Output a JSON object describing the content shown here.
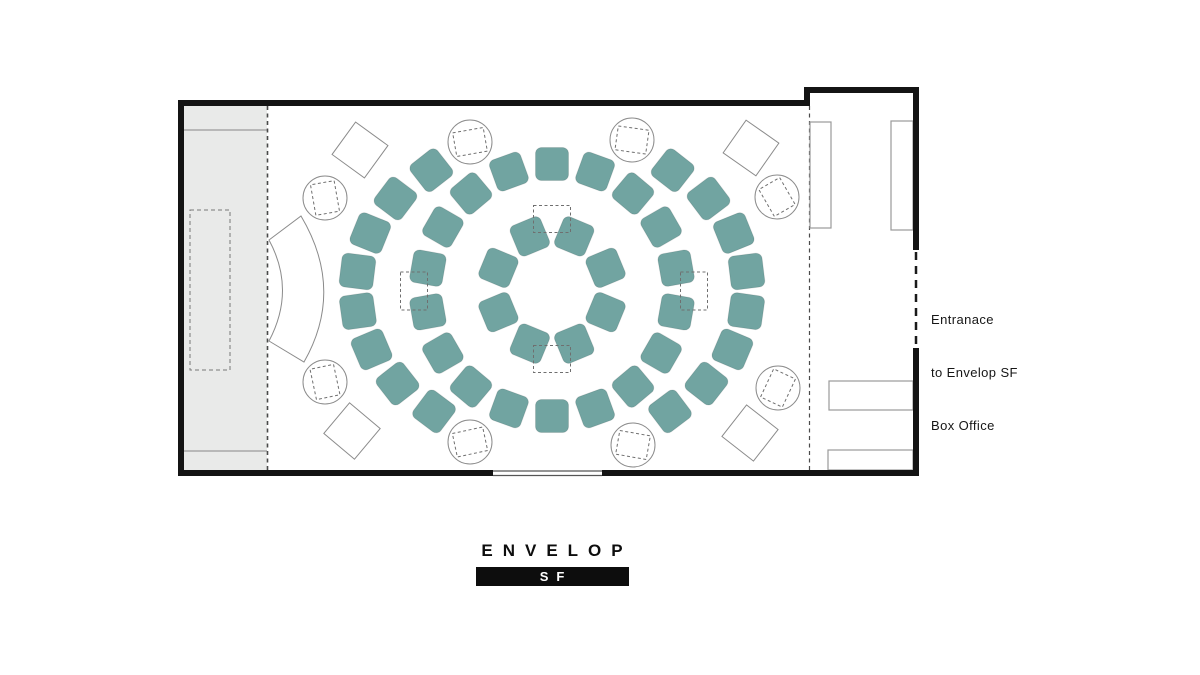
{
  "labels": {
    "entrance_line1": "Entranace",
    "entrance_line2": "to Envelop SF",
    "box_office": "Box Office",
    "logo": "ENVELOP",
    "logo_sub": "SF"
  },
  "colors": {
    "seat": "#71a4a1",
    "seat_edge": "rgba(0,0,0,0.10)",
    "wall": "#141414",
    "stage_fill": "#e9eae9",
    "outline": "#8b8b8b",
    "dashed": "#6f6f6f"
  },
  "seating": {
    "center": {
      "x": 552,
      "y": 290
    },
    "rings": [
      {
        "name": "inner-ring",
        "rx": 58,
        "ry": 58,
        "size": 33,
        "angles": [
          22.5,
          67.5,
          112.5,
          157.5,
          202.5,
          247.5,
          292.5,
          337.5
        ]
      },
      {
        "name": "middle-ring",
        "rx": 126,
        "ry": 126,
        "size": 33,
        "angles": [
          0,
          20,
          40,
          60,
          80,
          100,
          120,
          140,
          160,
          180,
          200,
          220,
          240,
          260,
          280,
          300,
          320,
          340
        ]
      },
      {
        "name": "outer-ring",
        "rx": 196,
        "ry": 152,
        "size": 34,
        "angles": [
          38,
          53,
          68,
          83,
          98,
          113,
          128,
          143,
          217,
          232,
          247,
          262,
          277,
          292,
          307,
          322
        ]
      }
    ],
    "equipment_slots": [
      {
        "x": 552,
        "y": 219,
        "w": 37,
        "h": 27
      },
      {
        "x": 552,
        "y": 359,
        "w": 37,
        "h": 27
      },
      {
        "x": 414,
        "y": 291,
        "w": 27,
        "h": 38
      },
      {
        "x": 694,
        "y": 291,
        "w": 27,
        "h": 38
      }
    ]
  },
  "speakers": {
    "circle_radius": 22,
    "circles": [
      {
        "x": 470,
        "y": 142,
        "rot": -10
      },
      {
        "x": 632,
        "y": 140,
        "rot": 8
      },
      {
        "x": 777,
        "y": 197,
        "rot": 60
      },
      {
        "x": 778,
        "y": 388,
        "rot": 115
      },
      {
        "x": 633,
        "y": 445,
        "rot": 10
      },
      {
        "x": 470,
        "y": 442,
        "rot": -12
      },
      {
        "x": 325,
        "y": 382,
        "rot": 78
      },
      {
        "x": 325,
        "y": 198,
        "rot": 80
      }
    ],
    "diamond_size": 40,
    "diamonds": [
      {
        "x": 360,
        "y": 150,
        "rot": 36
      },
      {
        "x": 751,
        "y": 148,
        "rot": 35
      },
      {
        "x": 750,
        "y": 433,
        "rot": 38
      },
      {
        "x": 352,
        "y": 431,
        "rot": 40
      }
    ]
  }
}
